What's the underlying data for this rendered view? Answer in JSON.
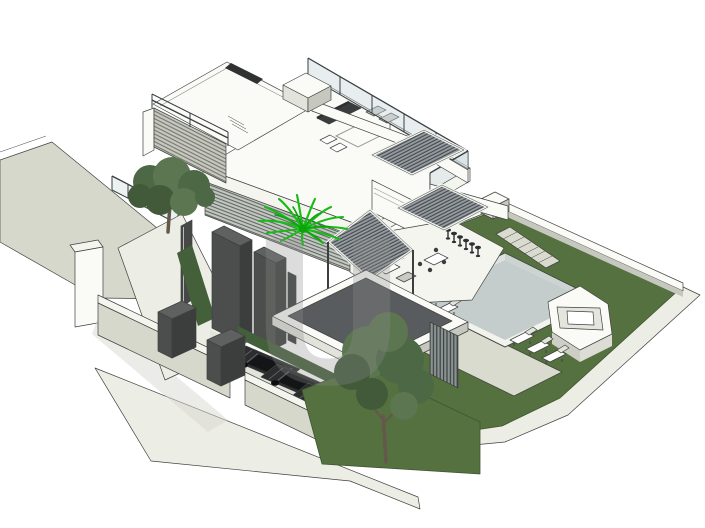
{
  "figure": {
    "type": "architectural-3d-isometric-render",
    "subject": "modern two-storey house with rooftop terrace, louvered pergola roofs, swimming pool, spa, driveway with three cars and landscaped lawns"
  },
  "watermark": {
    "letter": "U"
  },
  "palette": {
    "bg": "#ffffff",
    "edge": "#3f423f",
    "terrain": "#d7d8cc",
    "terrainCap": "#f5f5ef",
    "paleWall": "#ecede5",
    "wallWhite": "#fafaf6",
    "wallShade": "#e2e3da",
    "wallShadeDark": "#c6c8bf",
    "glass": "#c9d6d8",
    "glassFrame": "#3a3f42",
    "louverPanel": "#979da0",
    "louverLine": "#41464a",
    "louverFrame": "#f2f3ee",
    "stepLouverBg": "#c7c8c0",
    "stepLouverLine": "#6c6e66",
    "facadeBg": "#c3c7c1",
    "facadeLine": "#5a5f5a",
    "darkTower": "#4b4e4c",
    "darkTowerSide": "#3b3e3c",
    "darkTowerTop": "#5e615f",
    "grass": "#55713f",
    "grassDark": "#3f5531",
    "hedge": "#44603a",
    "foliage1": "#5b7650",
    "foliage2": "#4d6845",
    "foliage3": "#425a3a",
    "trunk": "#64584a",
    "palm": "#14bd14",
    "palmDark": "#0da30d",
    "poolRim": "#f2f3ed",
    "poolWallLight": "#dde2e0",
    "poolWallDark": "#ccd4d2",
    "poolFloor": "#c5cdcc",
    "deck": "#dadbcf",
    "spaMid": "#e4e5dd",
    "spaFaceA": "#dcddd4",
    "spaFaceB": "#cdcec5",
    "carBody": "#2b2d2e",
    "carCabin": "#131516",
    "carDetail": "#5d6163",
    "furnitureDark": "#3a3c3d",
    "furnitureLight": "#c9cac3",
    "stool": "#2e3031",
    "canopyPanel": "#585c5e",
    "slatScreenBg": "#8b9292",
    "slatLine": "#343a3a",
    "watermark": "#8d8d8d",
    "shadow": "#d8d8d1"
  },
  "scene": {
    "elements": [
      {
        "name": "rooftop-terrace",
        "label": "roof terrace with sofa, armchairs and rug"
      },
      {
        "name": "louvered-roof-panels",
        "label": "three slatted pergola roofs"
      },
      {
        "name": "stepped-louver-wall",
        "label": "louvered stair wall"
      },
      {
        "name": "dark-towers",
        "label": "dark service towers"
      },
      {
        "name": "entry-canopy",
        "label": "flat entry canopy with dark roof panel"
      },
      {
        "name": "ground-terrace",
        "label": "terrace with bar stools, dining set and lounge sofas"
      },
      {
        "name": "pool",
        "label": "sunken swimming pool"
      },
      {
        "name": "spa",
        "label": "raised square spa"
      },
      {
        "name": "sun-loungers",
        "label": "five pool loungers"
      },
      {
        "name": "lawn",
        "label": "sloped garden lawns"
      },
      {
        "name": "garden-steps",
        "label": "stepped garden path"
      },
      {
        "name": "driveway",
        "label": "driveway with three dark cars"
      },
      {
        "name": "planters",
        "label": "two dark planter boxes"
      },
      {
        "name": "trees",
        "label": "two leafy trees"
      },
      {
        "name": "palm",
        "label": "bright green palm"
      },
      {
        "name": "terrain",
        "label": "street-side retaining walls"
      }
    ]
  }
}
